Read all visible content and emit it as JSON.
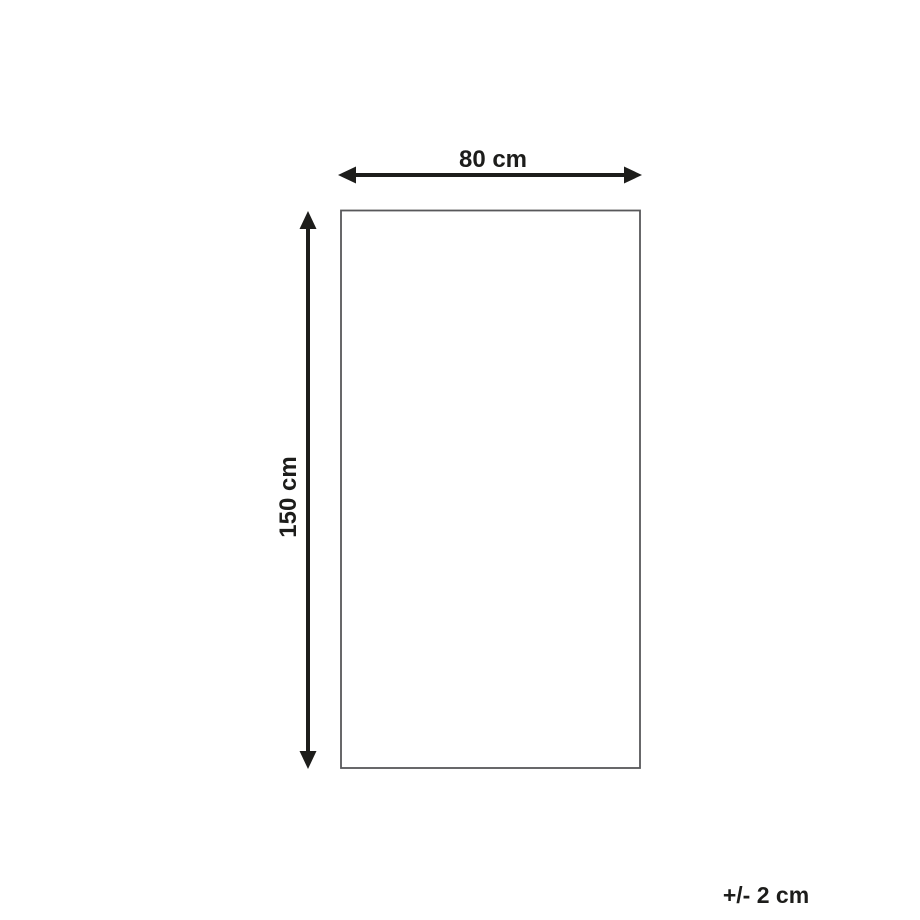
{
  "diagram": {
    "width_label": "80 cm",
    "height_label": "150 cm",
    "tolerance_label": "+/- 2 cm"
  },
  "colors": {
    "arrow": "#1d1d1b",
    "text": "#1d1d1b",
    "rectangle_border": "#58585a",
    "background": "#ffffff"
  }
}
